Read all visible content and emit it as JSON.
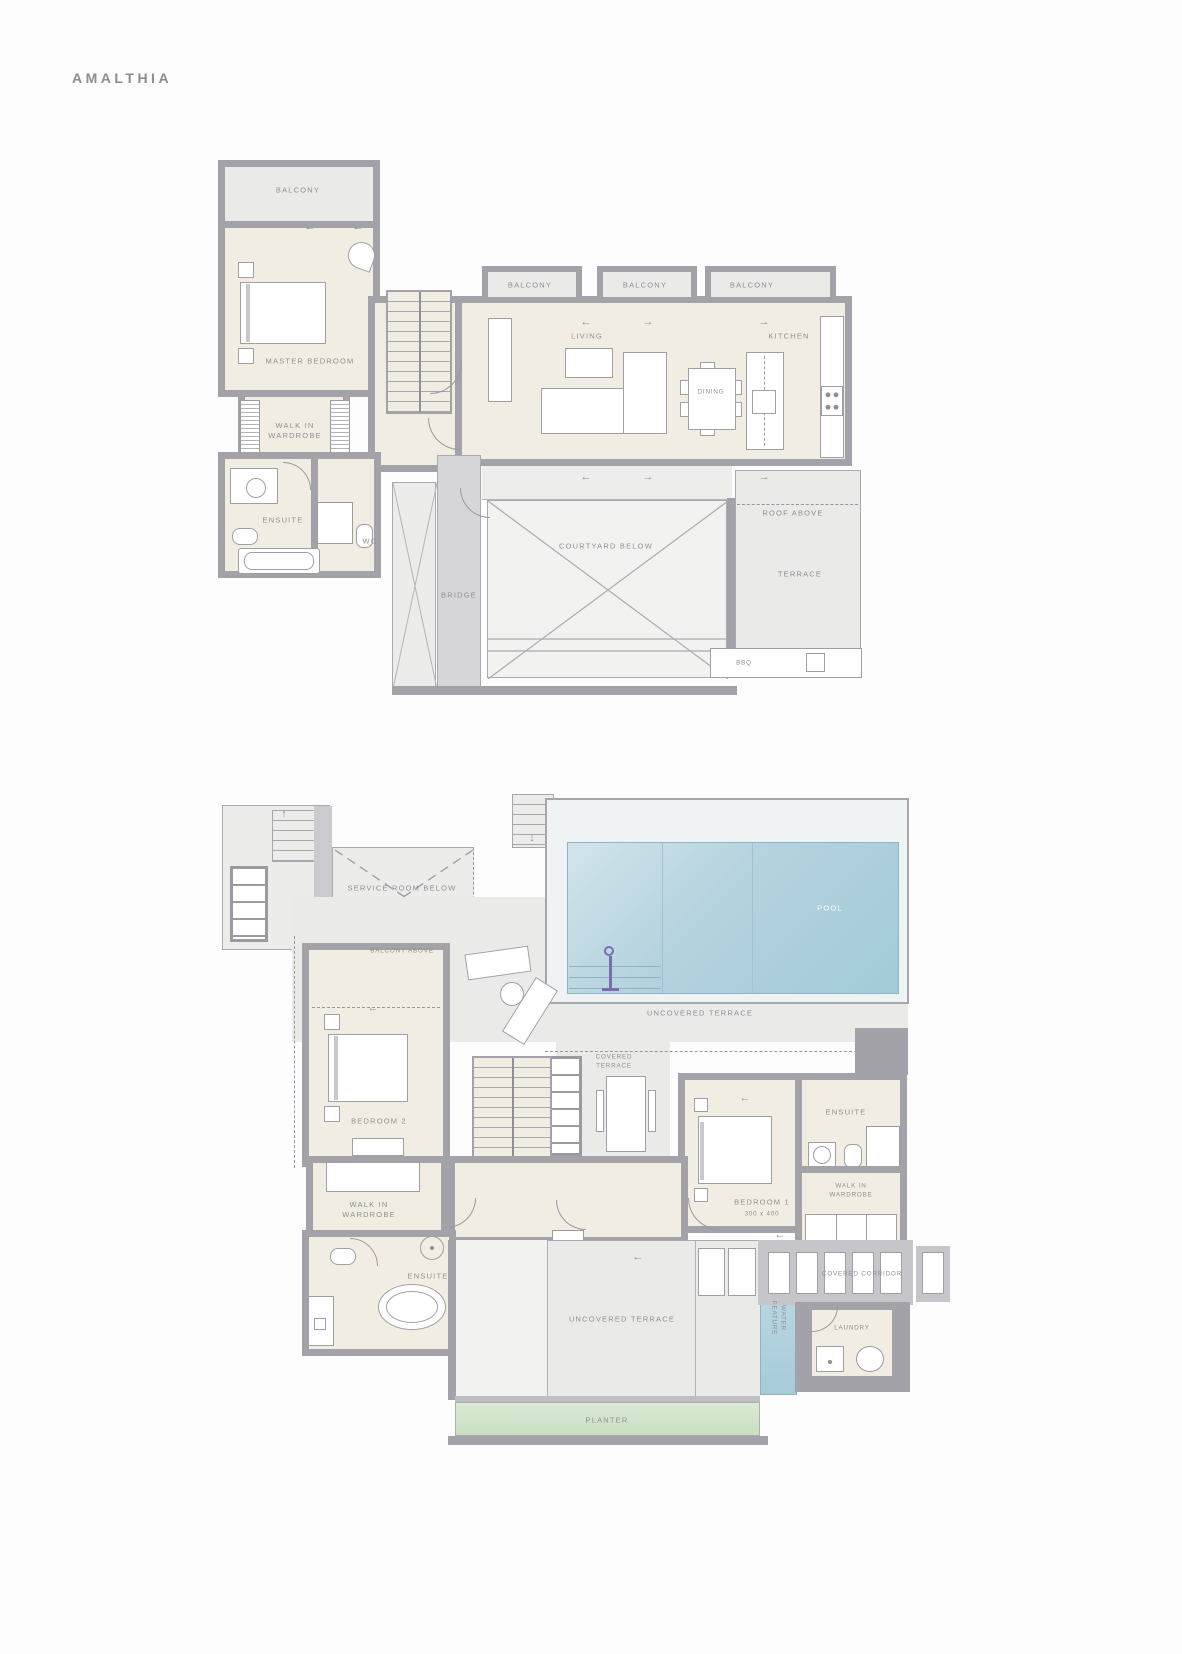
{
  "page": {
    "title": "AMALTHIA"
  },
  "icons": {
    "arrow_left": "←",
    "arrow_right": "→",
    "arrow_up": "↑",
    "arrow_down": "↓"
  },
  "colors": {
    "wall": "#a2a2a8",
    "room_fill": "#f1ede2",
    "terrace_fill": "#eaeae8",
    "pool_fill": "#a3cad8",
    "water_feature_fill": "#a9cedb",
    "planter_fill": "#d0e2c8",
    "label_text": "#8e8e94",
    "pool_label_text": "#ffffff",
    "accent_purple": "#7b6cb2"
  },
  "upper_plan": {
    "labels": {
      "balcony_master": "BALCONY",
      "master_bedroom": "MASTER BEDROOM",
      "walk_in_wardrobe": "WALK IN\nWARDROBE",
      "ensuite": "ENSUITE",
      "wc": "WC",
      "balcony_living": "BALCONY",
      "balcony_dining": "BALCONY",
      "balcony_kitchen": "BALCONY",
      "living": "LIVING",
      "dining": "DINING",
      "kitchen": "KITCHEN",
      "bridge": "BRIDGE",
      "courtyard_below": "COURTYARD BELOW",
      "roof_above": "ROOF ABOVE",
      "terrace": "TERRACE",
      "bbq": "BBQ"
    }
  },
  "lower_plan": {
    "labels": {
      "service_room_below": "SERVICE ROOM BELOW",
      "balcony_above": "BALCONY ABOVE",
      "pool": "POOL",
      "uncovered_terrace_pool": "UNCOVERED TERRACE",
      "covered_terrace": "COVERED\nTERRACE",
      "bedroom_2": "BEDROOM 2",
      "walk_in_wardrobe_2": "WALK IN\nWARDROBE",
      "ensuite_2": "ENSUITE",
      "bedroom_1": "BEDROOM 1",
      "bedroom_1_dim": "300 x 400",
      "ensuite_1": "ENSUITE",
      "walk_in_wardrobe_1": "WALK IN\nWARDROBE",
      "covered_corridor": "COVERED CORRIDOR",
      "laundry": "LAUNDRY",
      "water_feature": "WATER\nFEATURE",
      "uncovered_terrace_bottom": "UNCOVERED TERRACE",
      "planter": "PLANTER"
    }
  }
}
